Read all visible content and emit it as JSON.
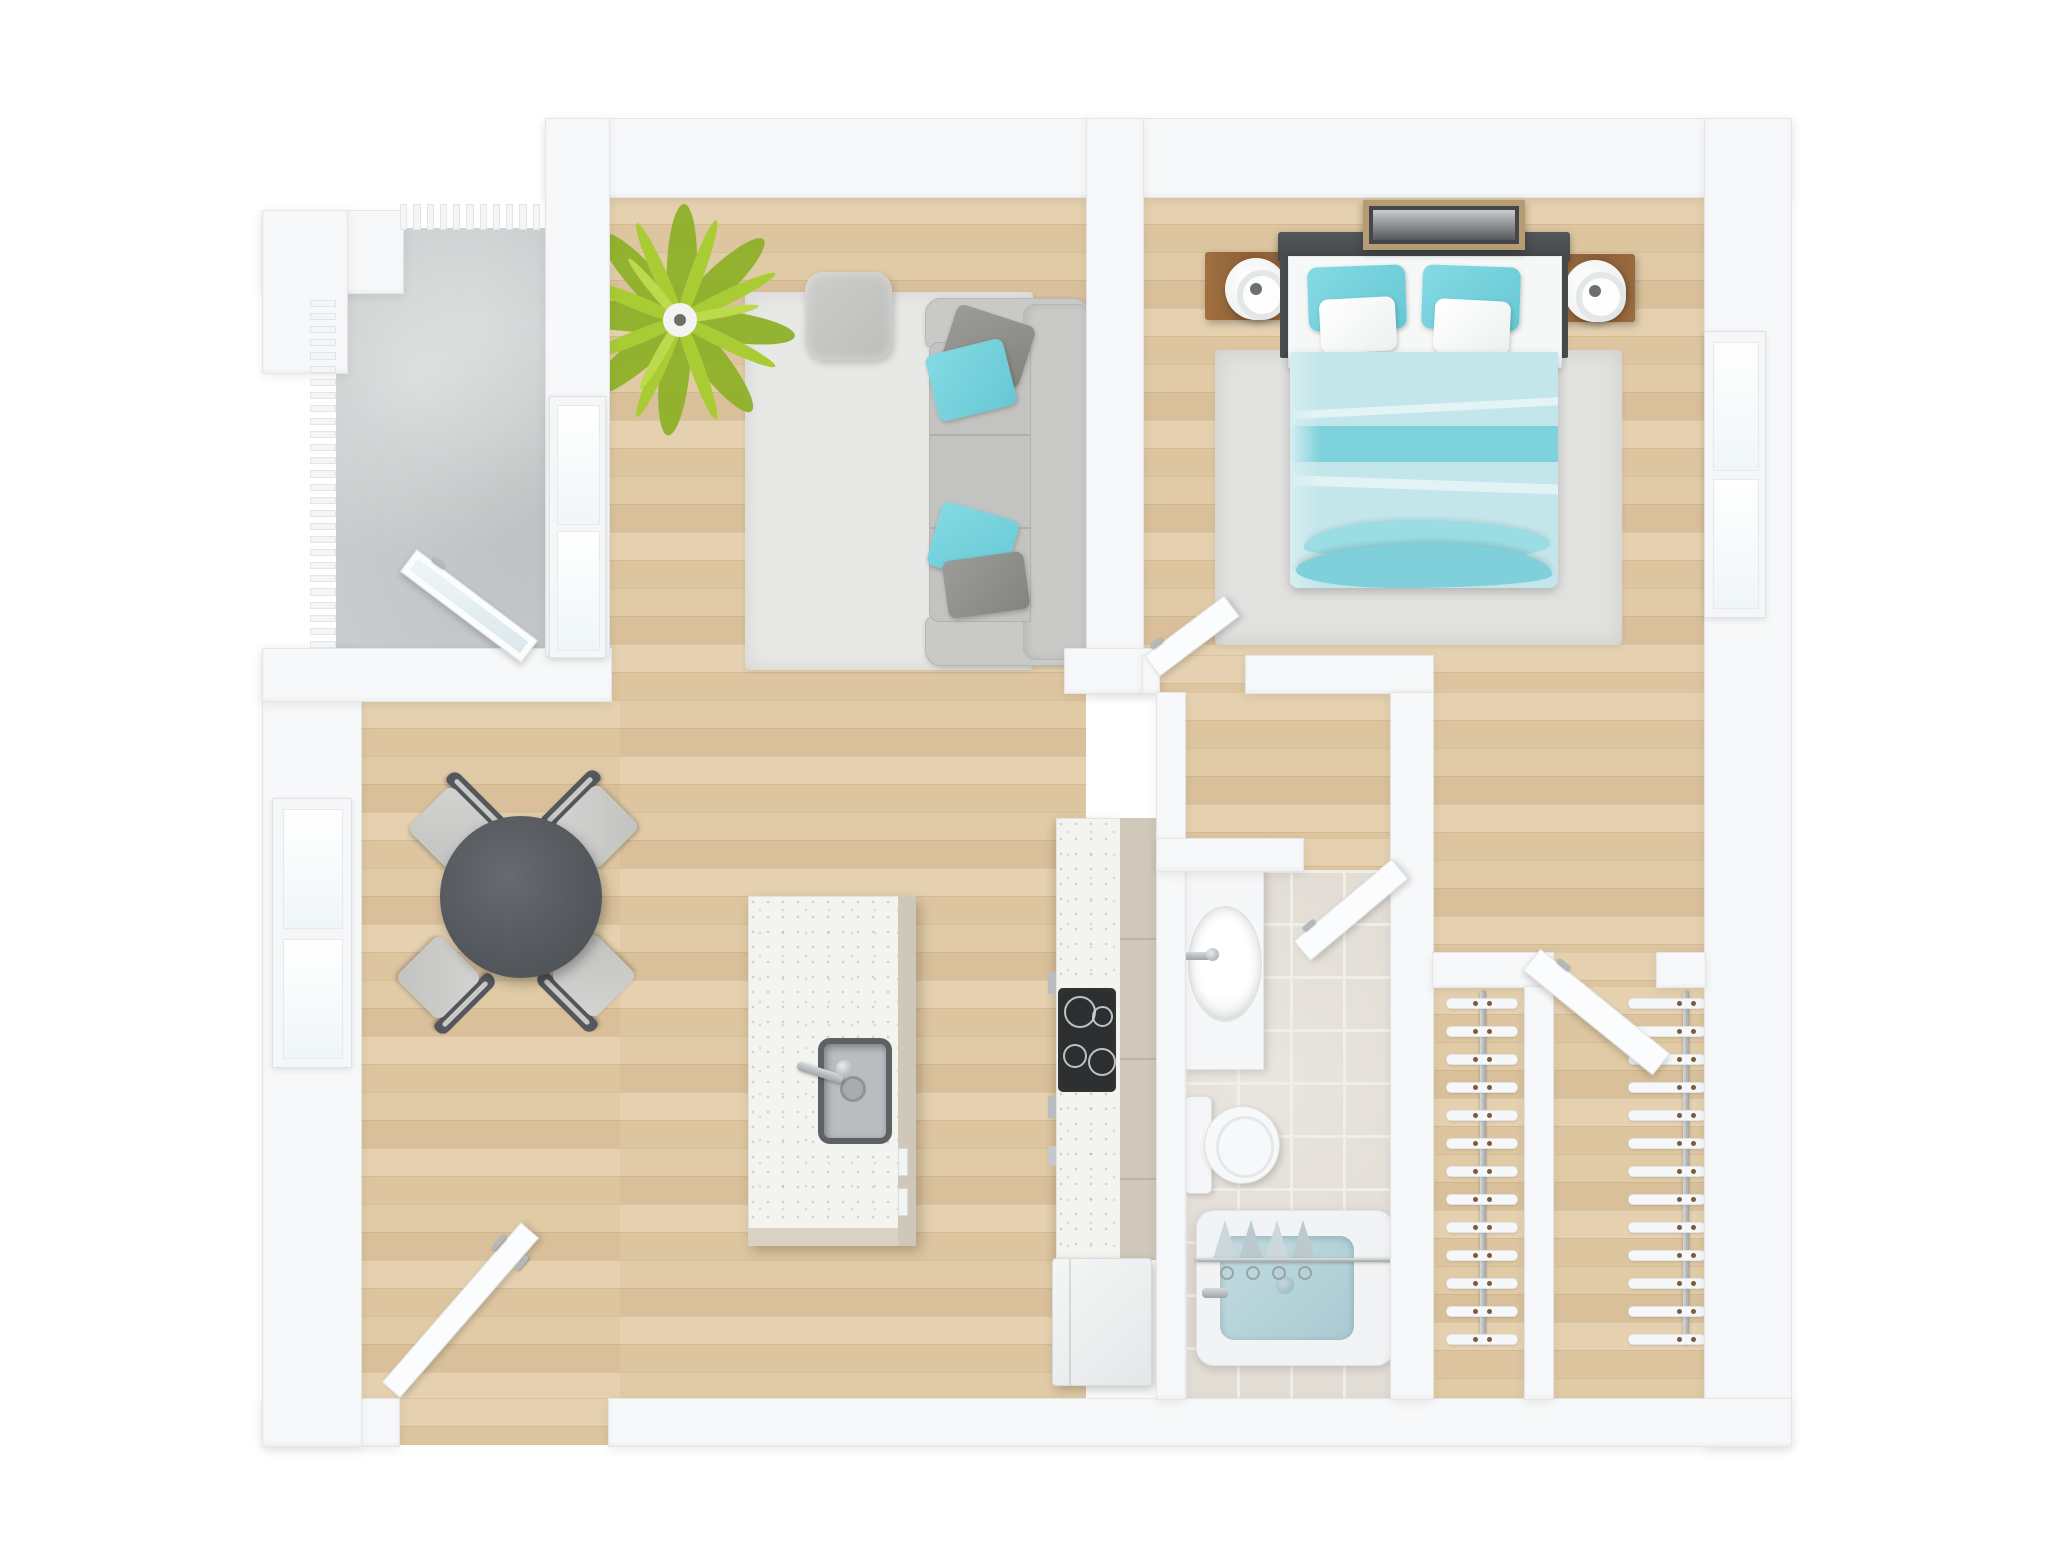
{
  "meta": {
    "title": "3D top-down floor plan render of a one-bedroom apartment",
    "style": "photoreal 3D dollhouse view, no text labels"
  },
  "palette": {
    "wall": "#f7f8f9",
    "wood_floor": "#e2cda9",
    "concrete": "#c9cccd",
    "tile": "#e2ddd5",
    "accent_teal": "#74d2dd",
    "blanket_teal": "#bfe4e9",
    "sofa_gray": "#c9c9c7",
    "table_gray": "#5b5f63",
    "cabinet_greige": "#cfc7b8",
    "stove_black": "#2c2e30",
    "nightstand_wood": "#9a6b41",
    "plant_green": "#a9cb33",
    "tub_water": "#b5d2d9"
  },
  "rooms": {
    "balcony": {
      "name": "Balcony",
      "floor": "concrete",
      "features": [
        "slatted railing",
        "open glass door"
      ]
    },
    "living": {
      "name": "Living room",
      "furniture": [
        "three-seat sofa",
        "2 teal pillows",
        "2 gray pillows",
        "ottoman",
        "area rug",
        "palm plant",
        "console table"
      ]
    },
    "dining": {
      "name": "Dining area",
      "furniture": [
        "round dark table",
        "4 chairs"
      ],
      "window": true
    },
    "kitchen": {
      "name": "Kitchen",
      "furniture": [
        "island with sink and faucet",
        "counter run",
        "4-burner cooktop",
        "tall cabinet",
        "refrigerator"
      ]
    },
    "bathroom": {
      "name": "Bathroom",
      "fixtures": [
        "vanity with oval sink",
        "toilet",
        "bathtub with shower curtain and rod"
      ],
      "floor": "tile"
    },
    "bedroom": {
      "name": "Bedroom",
      "furniture": [
        "double bed with teal bedding",
        "2 teal pillows",
        "2 white pillows",
        "2 wood nightstands",
        "2 round lamps",
        "area rug",
        "dark wall art"
      ],
      "window": true
    },
    "closet_left": {
      "name": "Closet (left)"
    },
    "closet_right": {
      "name": "Closet (right)"
    },
    "hallway": {
      "name": "Hallway"
    }
  },
  "counts": {
    "top_railing_slats": 11,
    "left_railing_slats": 27,
    "left_closet_hangers": 13,
    "right_closet_hangers": 13,
    "curtain_folds": 4,
    "sofa_seat_cushions": 3,
    "dining_chairs": 4,
    "cooktop_burners": 4
  }
}
